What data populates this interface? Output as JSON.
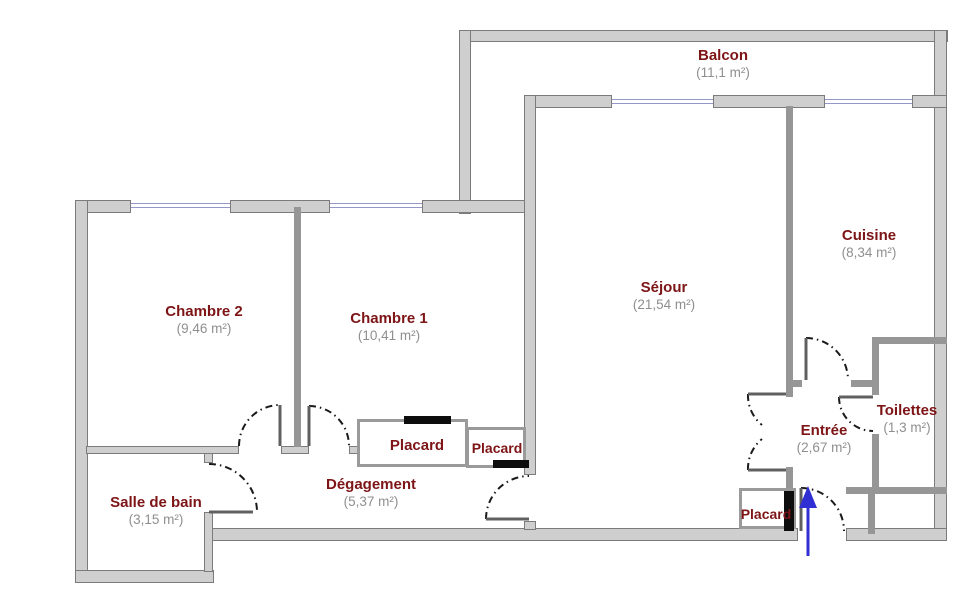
{
  "rooms": {
    "balcon": {
      "name": "Balcon",
      "area": "(11,1 m²)"
    },
    "cuisine": {
      "name": "Cuisine",
      "area": "(8,34 m²)"
    },
    "sejour": {
      "name": "Séjour",
      "area": "(21,54 m²)"
    },
    "chambre2": {
      "name": "Chambre 2",
      "area": "(9,46 m²)"
    },
    "chambre1": {
      "name": "Chambre 1",
      "area": "(10,41 m²)"
    },
    "salle_de_bain": {
      "name": "Salle de bain",
      "area": "(3,15 m²)"
    },
    "degagement": {
      "name": "Dégagement",
      "area": "(5,37 m²)"
    },
    "entree": {
      "name": "Entrée",
      "area": "(2,67 m²)"
    },
    "toilettes": {
      "name": "Toilettes",
      "area": "(1,3 m²)"
    },
    "placard_couloir": {
      "name": "Placard"
    },
    "placard_couloir_2": {
      "name": "Placard"
    },
    "placard_entree": {
      "name": "Placard"
    }
  },
  "icons": {
    "entrance_arrow": "up-arrow"
  },
  "colors": {
    "room_name": "#7d1416",
    "room_area": "#8f8f8f",
    "wall_fill": "#cfcfcf",
    "wall_edge": "#7b7b7b",
    "partition": "#969696",
    "window": "#9597c9",
    "closet_door_bar": "#0d0d0d",
    "entrance_arrow": "#2f2fd3"
  }
}
